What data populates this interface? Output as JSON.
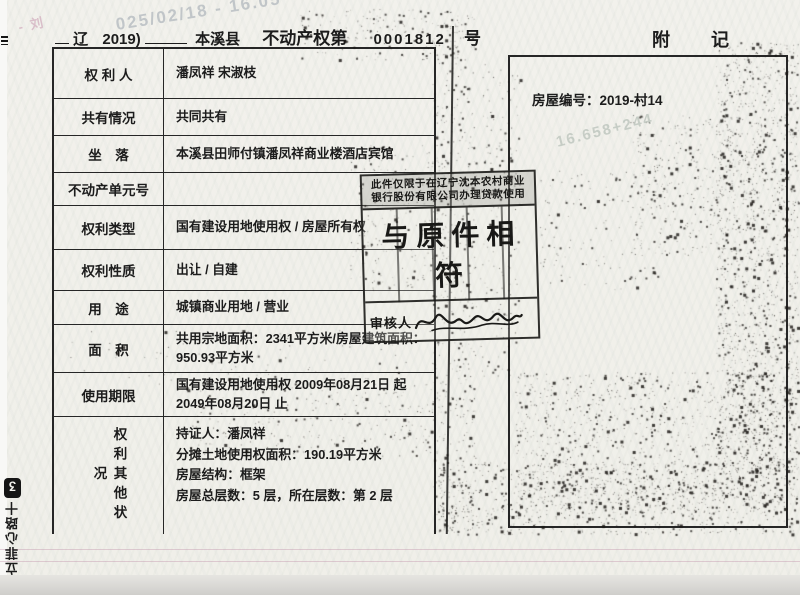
{
  "header": {
    "prefix": "辽",
    "year": "2019)",
    "county": "本溪县",
    "doc_type": "不动产权第",
    "number": "0001812",
    "suffix": "号",
    "right_title": "附  记"
  },
  "table": {
    "rows": [
      {
        "label": "权 利 人",
        "value": "潘凤祥 宋淑枝"
      },
      {
        "label": "共有情况",
        "value": "共同共有"
      },
      {
        "label": "坐　落",
        "value": "本溪县田师付镇潘凤祥商业楼酒店宾馆"
      },
      {
        "label": "不动产单元号",
        "value": ""
      },
      {
        "label": "权利类型",
        "value": "国有建设用地使用权 / 房屋所有权"
      },
      {
        "label": "权利性质",
        "value": "出让 / 自建"
      },
      {
        "label": "用　途",
        "value": "城镇商业用地 / 营业"
      },
      {
        "label": "面　积",
        "value": "共用宗地面积：2341平方米/房屋建筑面积：950.93平方米"
      },
      {
        "label": "使用期限",
        "value": "国有建设用地使用权 2009年08月21日 起 2049年08月20日 止"
      }
    ],
    "other_rights": {
      "label": "权利其他状况",
      "line1": "持证人：潘凤祥",
      "line2": "分摊土地使用权面积：190.19平方米",
      "line3": "房屋结构：框架",
      "line4": "房屋总层数：5 层，所在层数：第 2 层"
    }
  },
  "notes": {
    "house_number": "房屋编号：2019-村14"
  },
  "stamp": {
    "restriction_line1": "此件仅限于在辽宁沈本农村商业",
    "restriction_line2": "银行股份有限公司办理贷款使用",
    "main_text": "与原件相符",
    "reviewer_label": "审核人"
  },
  "watermarks": {
    "timestamp": "025/02/18 - 16.05",
    "code": "16.658+244",
    "corner_fragment": "- 刘"
  },
  "edge_mark": {
    "logo_glyph": "ʒ",
    "text": "立菲心路十"
  },
  "colors": {
    "ink": "#1c1c1c",
    "paper": "#f1f0ea",
    "stamp_ink": "#191917",
    "watermark_gray": "#b6bcc1",
    "watermark_pink": "#d5b3c2"
  }
}
